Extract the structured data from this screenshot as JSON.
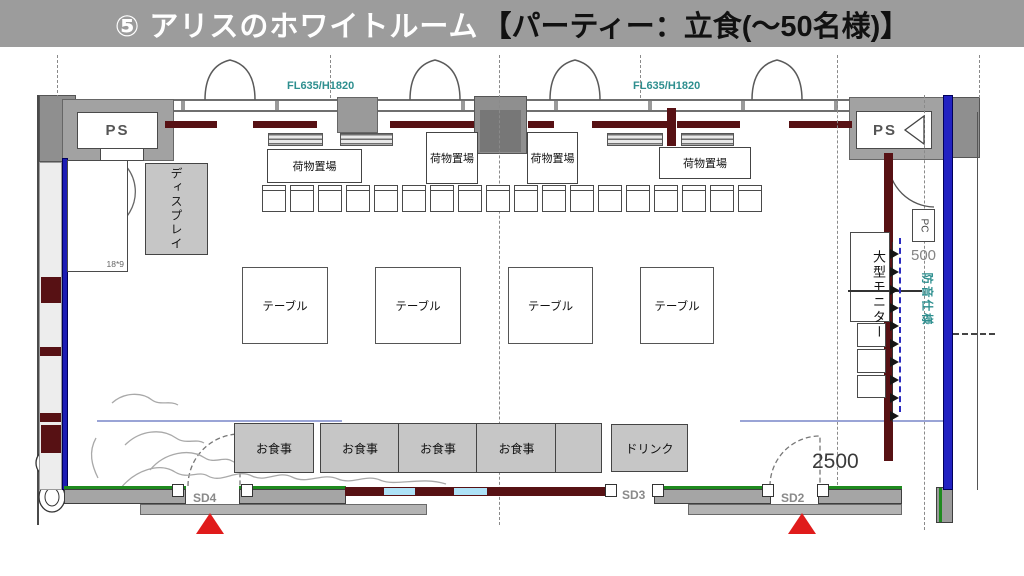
{
  "title": {
    "main": "⑤ アリスのホワイトルーム",
    "bracket": "【パーティー：立食(～50名様)】"
  },
  "top_wall": {
    "window_specs": [
      "FL635/H1820",
      "FL635/H1820"
    ],
    "ps_left": "PS",
    "ps_right": "PS"
  },
  "storage": {
    "luggage_labels": [
      "荷物置場",
      "荷物置場",
      "荷物置場",
      "荷物置場"
    ],
    "stacked_chairs_count": 18
  },
  "tables": {
    "labels": [
      "テーブル",
      "テーブル",
      "テーブル",
      "テーブル"
    ]
  },
  "buffet": {
    "food_labels": [
      "お食事",
      "お食事",
      "お食事",
      "お食事"
    ],
    "drink_label": "ドリンク"
  },
  "fixtures": {
    "display": "ディスプレイ",
    "monitor": "大型モニター",
    "monitor_plug_count": 10,
    "pc": "PC",
    "soundproof": "防音仕様"
  },
  "doors": {
    "sd2": "SD2",
    "sd3": "SD3",
    "sd4": "SD4"
  },
  "dims": {
    "v500": "500",
    "v2500": "2500",
    "v18x9": "18*9"
  },
  "colors": {
    "title_bar": "#9c9c9c",
    "maroon": "#571114",
    "blue_wall": "#2222c2",
    "teal_text": "#2e8f8f",
    "marker_red": "#e01b1b",
    "green_line": "#1f8a1f",
    "window_blue": "#aee2f7",
    "furniture_gray": "#c6c6c6"
  }
}
